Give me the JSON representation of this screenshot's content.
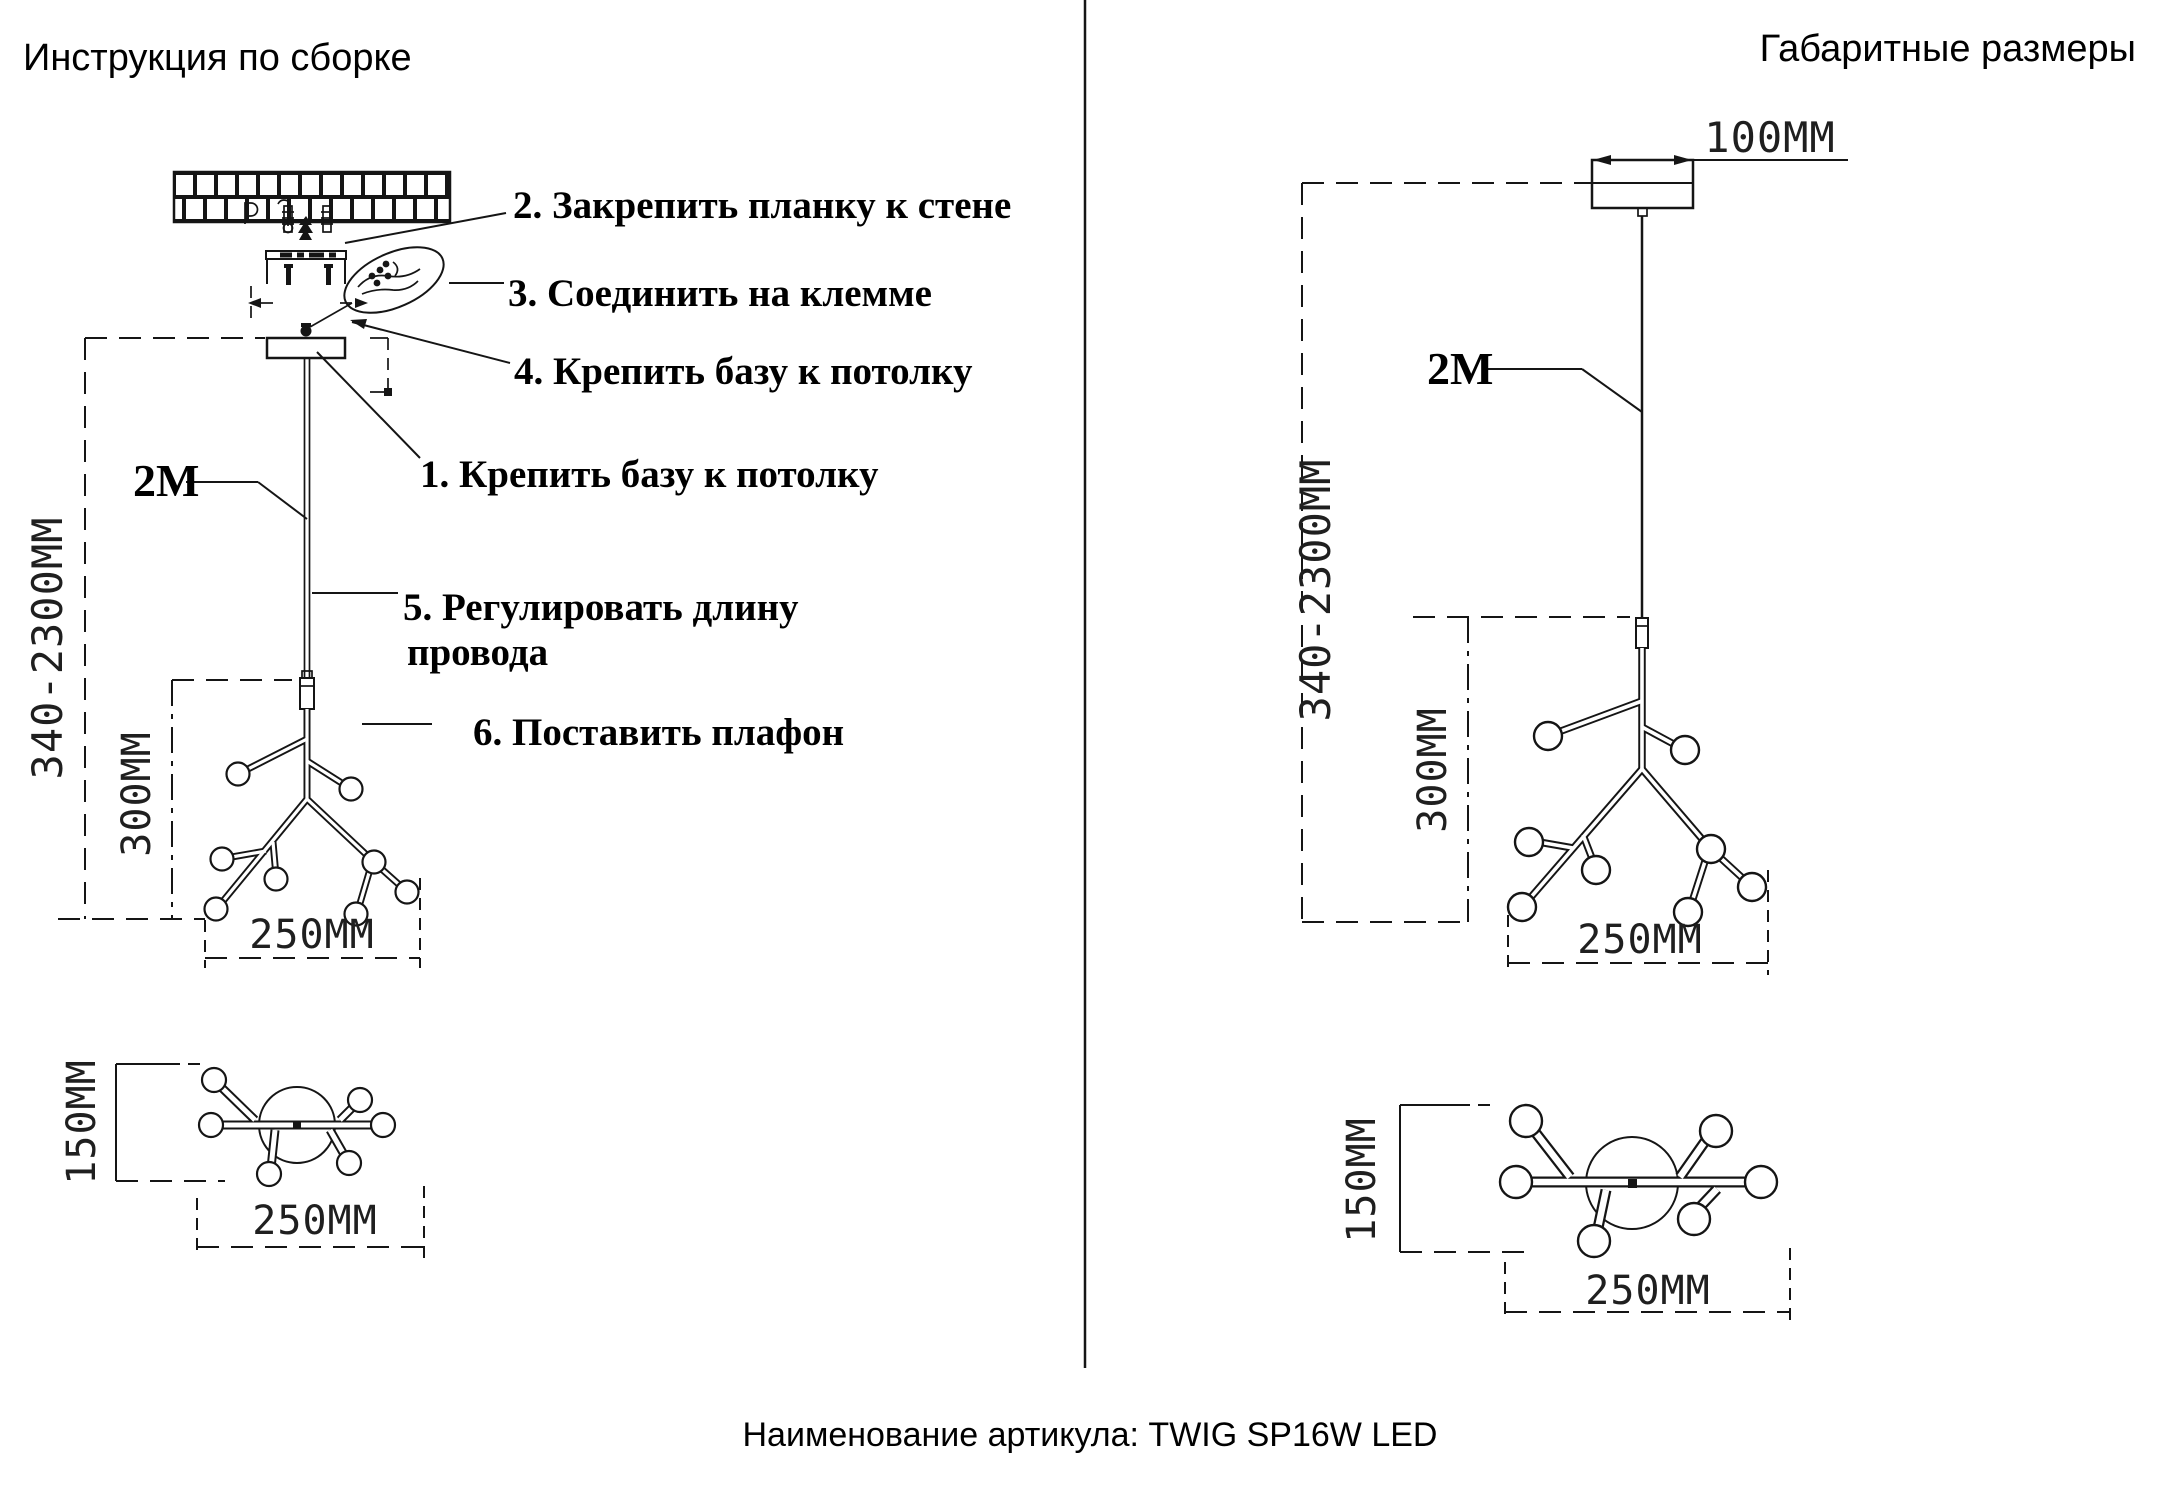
{
  "left_panel": {
    "title": "Инструкция по сборке",
    "steps": {
      "s1": "1. Крепить базу к потолку",
      "s2": "2. Закрепить планку к стене",
      "s3": "3. Соединить на клемме",
      "s4": "4. Крепить базу к потолку",
      "s5_line1": "5. Регулировать длину",
      "s5_line2": "провода",
      "s6": "6. Поставить плафон"
    },
    "dims": {
      "cable": "2M",
      "height_range": "340-2300MM",
      "cluster_height": "300MM",
      "cluster_width": "250MM",
      "top_view_height": "150MM",
      "top_view_width": "250MM"
    }
  },
  "right_panel": {
    "title": "Габаритные размеры",
    "dims": {
      "canopy_width": "100MM",
      "cable": "2M",
      "height_range": "340-2300MM",
      "cluster_height": "300MM",
      "cluster_width": "250MM",
      "top_view_height": "150MM",
      "top_view_width": "250MM"
    }
  },
  "footer": {
    "article": "Наименование артикула: TWIG SP16W LED"
  }
}
